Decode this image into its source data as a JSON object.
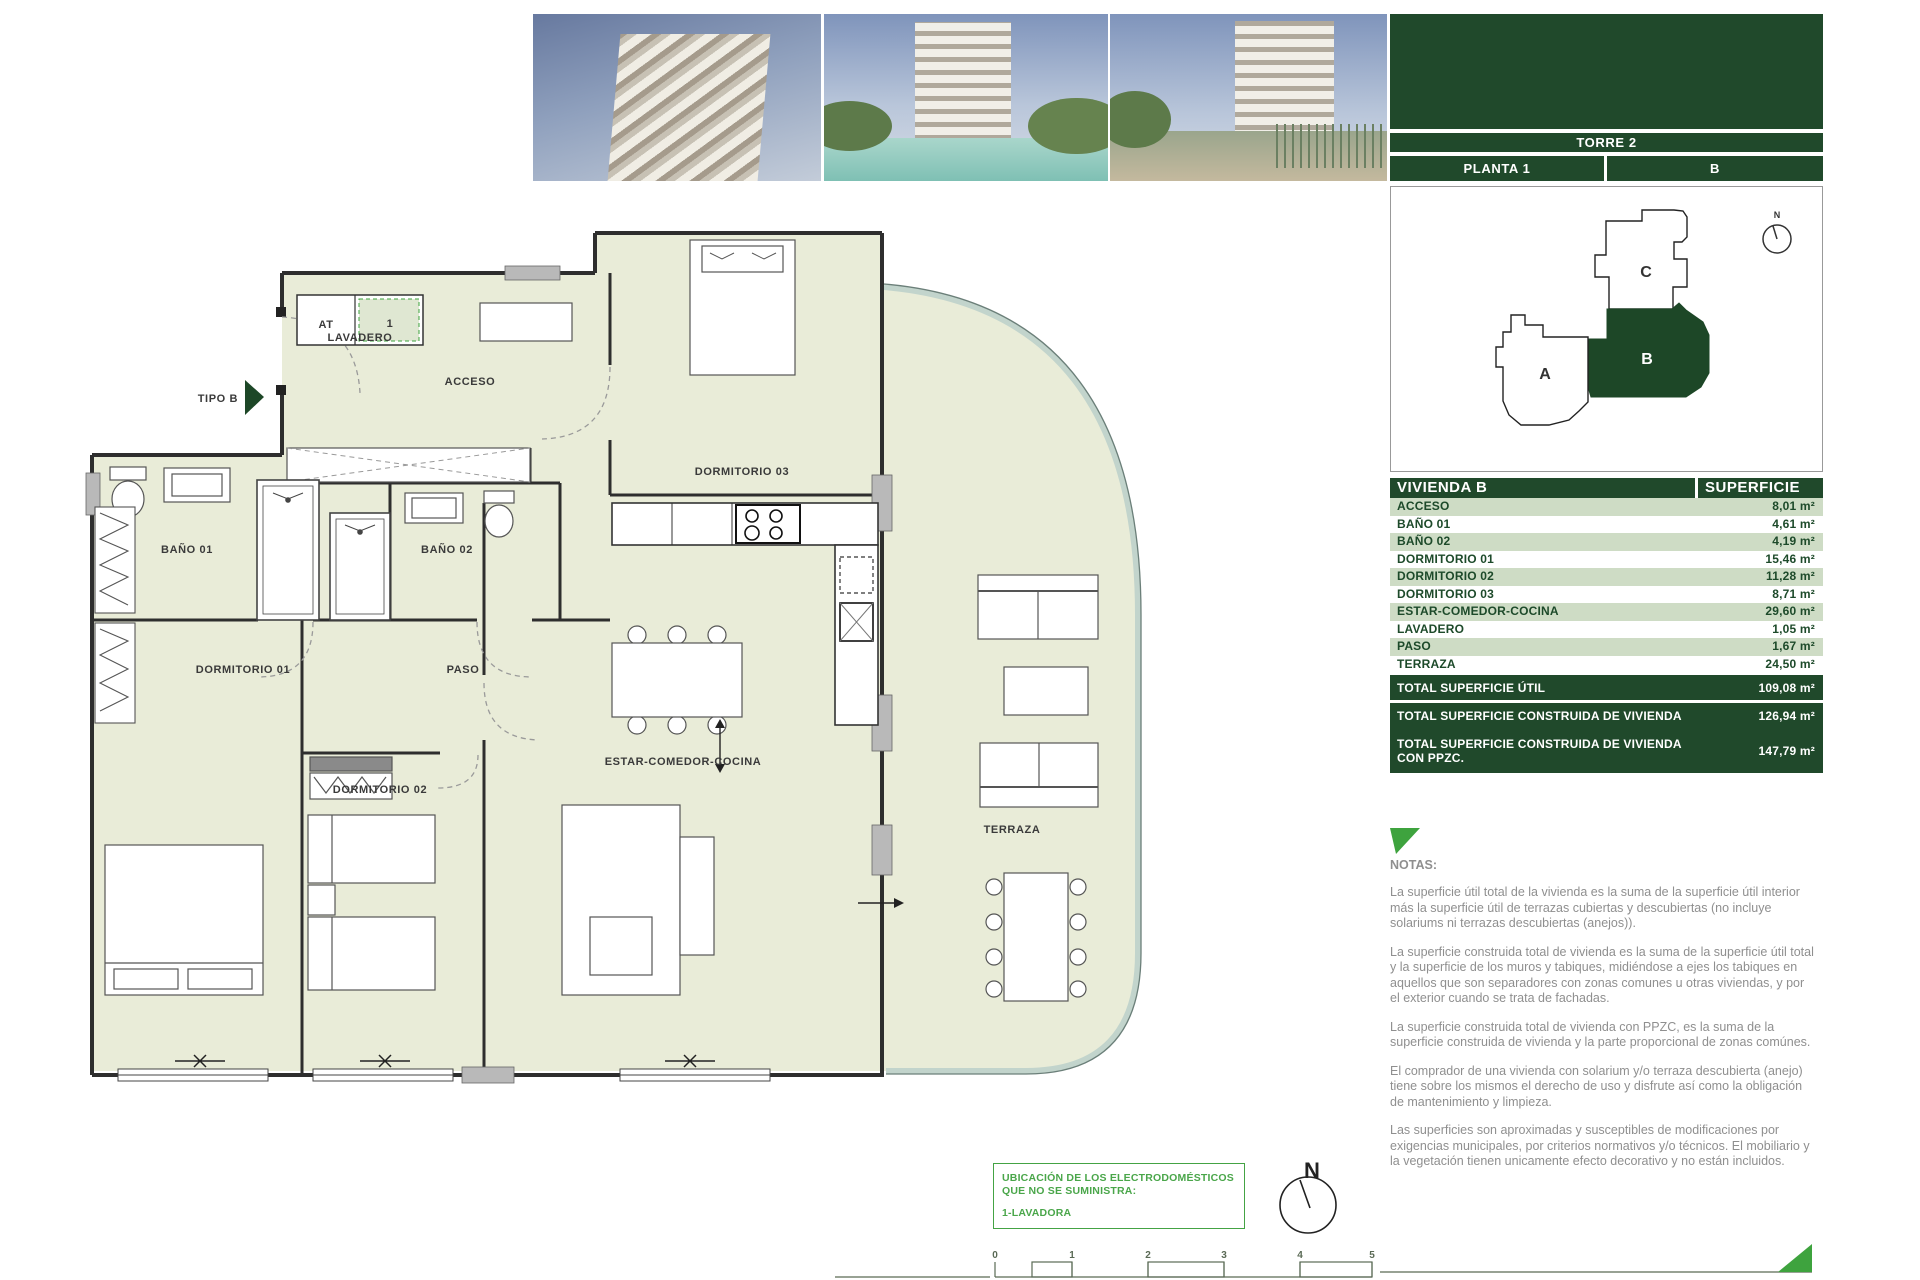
{
  "header": {
    "torre": "TORRE 2",
    "planta": "PLANTA 1",
    "unit": "B"
  },
  "keyplan": {
    "units": [
      "A",
      "B",
      "C"
    ],
    "selected": "B",
    "north": "N"
  },
  "table": {
    "title": "VIVIENDA B",
    "superficie_header": "SUPERFICIE",
    "rows": [
      {
        "label": "ACCESO",
        "value": "8,01 m²"
      },
      {
        "label": "BAÑO 01",
        "value": "4,61 m²"
      },
      {
        "label": "BAÑO 02",
        "value": "4,19 m²"
      },
      {
        "label": "DORMITORIO 01",
        "value": "15,46 m²"
      },
      {
        "label": "DORMITORIO 02",
        "value": "11,28 m²"
      },
      {
        "label": "DORMITORIO 03",
        "value": "8,71 m²"
      },
      {
        "label": "ESTAR-COMEDOR-COCINA",
        "value": "29,60 m²"
      },
      {
        "label": "LAVADERO",
        "value": "1,05 m²"
      },
      {
        "label": "PASO",
        "value": "1,67 m²"
      },
      {
        "label": "TERRAZA",
        "value": "24,50 m²"
      }
    ],
    "totals": [
      {
        "label": "TOTAL SUPERFICIE ÚTIL",
        "value": "109,08 m²"
      },
      {
        "label": "TOTAL SUPERFICIE CONSTRUIDA DE VIVIENDA",
        "value": "126,94 m²"
      },
      {
        "label": "TOTAL SUPERFICIE CONSTRUIDA DE VIVIENDA CON PPZC.",
        "value": "147,79 m²"
      }
    ]
  },
  "notes": {
    "title": "NOTAS:",
    "paragraphs": [
      "La superficie útil total de la vivienda es la suma de la superficie útil interior más la superficie útil de terrazas cubiertas y descubiertas (no incluye solariums ni terrazas descubiertas (anejos)).",
      "La superficie construida total de vivienda es la suma de la superficie útil total y la superficie de los muros y tabiques, midiéndose a ejes los tabiques en aquellos que son separadores con zonas comunes u otras viviendas, y por el exterior cuando se trata de fachadas.",
      "La superficie construida total de vivienda con PPZC, es la suma de la superficie construida de vivienda y la parte proporcional de zonas comúnes.",
      "El comprador de una vivienda con solarium y/o terraza descubierta (anejo) tiene sobre los mismos el derecho de uso y disfrute así como la obligación de mantenimiento y limpieza.",
      "Las superficies son aproximadas y susceptibles de modificaciones por exigencias municipales, por criterios normativos y/o técnicos. El mobiliario y la vegetación tienen unicamente efecto decorativo y no están incluidos."
    ]
  },
  "plan": {
    "tipo": "TIPO B",
    "labels": {
      "acceso": "ACCESO",
      "dorm03": "DORMITORIO 03",
      "bano01": "BAÑO 01",
      "bano02": "BAÑO 02",
      "dorm01": "DORMITORIO 01",
      "paso": "PASO",
      "dorm02": "DORMITORIO 02",
      "estar": "ESTAR-COMEDOR-COCINA",
      "terraza": "TERRAZA",
      "at": "AT",
      "lavadero": "LAVADERO",
      "unit1": "1"
    }
  },
  "appliance_box": {
    "line1": "UBICACIÓN DE LOS ELECTRODOMÉSTICOS QUE NO SE SUMINISTRA:",
    "line2": "1-LAVADORA"
  },
  "compass": {
    "north": "N"
  },
  "scalebar": {
    "ticks": [
      "0",
      "1",
      "2",
      "3",
      "4",
      "5"
    ]
  },
  "colors": {
    "dark_green": "#20492b",
    "row_green": "#cedcc5",
    "accent_green": "#3ea33e",
    "floor": "#e9ecd8"
  }
}
